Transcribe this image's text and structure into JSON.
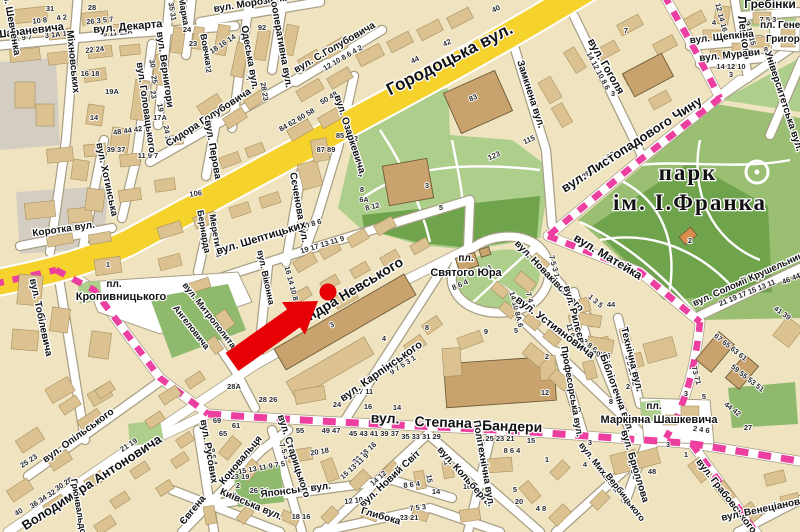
{
  "map": {
    "colors": {
      "block_bg": "#EFE3C0",
      "building": "#DCC291",
      "building_outline": "#A8905F",
      "public_building": "#C9A36E",
      "public_outline": "#6E5B36",
      "orange_building": "#D98D4E",
      "road_fill": "#FFFFFF",
      "road_casing": "#A89F85",
      "major_road_yellow": "#F5D22C",
      "green_light": "#AECE8C",
      "green_mid": "#8FB96D",
      "green_dark": "#6FA44C",
      "gray_zone": "#D4CEC2",
      "route_pink": "#EC3F9F",
      "marker_red": "#E80007",
      "label_color": "#121212"
    },
    "street_labels": [
      [
        "Шараневича",
        30,
        34,
        -7,
        11
      ],
      [
        "вул. Декарта",
        128,
        30,
        -5,
        11
      ],
      [
        "Міхновських",
        70,
        62,
        84,
        10
      ],
      [
        "вул. Головацького",
        143,
        108,
        82,
        10
      ],
      [
        "вул. Вернигори",
        162,
        70,
        82,
        10
      ],
      [
        "Марка",
        181,
        12,
        80,
        9
      ],
      [
        "Вовчка",
        203,
        50,
        80,
        9
      ],
      [
        "Одеська вул.",
        247,
        58,
        80,
        10
      ],
      [
        "вул. Морозенка",
        252,
        6,
        -9,
        10
      ],
      [
        "Кооперативна вул.",
        278,
        42,
        80,
        10
      ],
      [
        "вул. С.Голубовича",
        336,
        50,
        -30,
        10
      ],
      [
        "Сидора Голубовича",
        210,
        120,
        -33,
        10
      ],
      [
        "вул. Перова",
        210,
        150,
        80,
        10
      ],
      [
        "Бернарда",
        201,
        232,
        80,
        9
      ],
      [
        "Меретина",
        213,
        236,
        80,
        9
      ],
      [
        "Коротка вул.",
        64,
        232,
        -8,
        10
      ],
      [
        "вул. Хотинська",
        104,
        180,
        78,
        10
      ],
      [
        "Сєченова вул.",
        296,
        208,
        80,
        10
      ],
      [
        "вул. Озаркевича",
        347,
        135,
        72,
        10
      ],
      [
        "Городоцька вул.",
        452,
        64,
        -27,
        17
      ],
      [
        "Замкнена вул.",
        528,
        95,
        72,
        10
      ],
      [
        "вул. Гоголя",
        603,
        68,
        60,
        11
      ],
      [
        "Лепкого",
        741,
        38,
        82,
        11
      ],
      [
        "Гребінки",
        770,
        8,
        0,
        12
      ],
      [
        "вул. Щепкіна",
        722,
        40,
        -6,
        10
      ],
      [
        "вул. Мурави",
        730,
        58,
        -6,
        10
      ],
      [
        "пл. Генерала",
        792,
        28,
        0,
        10
      ],
      [
        "Григоренка",
        794,
        42,
        0,
        10
      ],
      [
        "Університетська вул.",
        781,
        102,
        72,
        10
      ],
      [
        "вул. Листопадового Чину",
        634,
        148,
        -33,
        13
      ],
      [
        "парк",
        688,
        180,
        0,
        23,
        1
      ],
      [
        "ім. І.Франка",
        690,
        210,
        0,
        23,
        1
      ],
      [
        "вул. Матейка",
        606,
        260,
        31,
        12
      ],
      [
        "вул. Соломії Крушельницької",
        758,
        278,
        -24,
        9.5
      ],
      [
        "пл.",
        466,
        261,
        0,
        10
      ],
      [
        "Святого Юра",
        466,
        276,
        0,
        11
      ],
      [
        "вул. Шептицьких",
        262,
        241,
        -17,
        11
      ],
      [
        "вул. Віконна",
        263,
        278,
        78,
        9
      ],
      [
        "вул. Олександра Невського",
        322,
        314,
        -31,
        14
      ],
      [
        "вул. Карпінського",
        383,
        374,
        -35,
        11
      ],
      [
        "вул. Новаківського",
        547,
        278,
        46,
        10
      ],
      [
        "вул. Рилєєва",
        572,
        318,
        75,
        10
      ],
      [
        "вул. Устияновича",
        553,
        330,
        37,
        11
      ],
      [
        "Технічна вул.",
        629,
        360,
        76,
        10
      ],
      [
        "Бібліотечна вул.",
        614,
        394,
        70,
        10
      ],
      [
        "Професорська вул.",
        569,
        392,
        80,
        9.5
      ],
      [
        "вул.",
        385,
        423,
        2,
        14
      ],
      [
        "Степана",
        443,
        427,
        2,
        14
      ],
      [
        "Бандери",
        512,
        431,
        2,
        14
      ],
      [
        "вул. Кольберга",
        462,
        478,
        48,
        10
      ],
      [
        "Політехнічна вул.",
        481,
        464,
        80,
        10
      ],
      [
        "вул. Новий Світ",
        392,
        481,
        -43,
        10
      ],
      [
        "Глибока",
        380,
        519,
        16,
        10
      ],
      [
        "Японська вул.",
        296,
        493,
        -7,
        10
      ],
      [
        "вул. Старицького",
        291,
        457,
        72,
        10
      ],
      [
        "Коновальця",
        243,
        462,
        -50,
        10
      ],
      [
        "Євгена",
        195,
        512,
        -50,
        10
      ],
      [
        "Київська вул.",
        250,
        507,
        23,
        10
      ],
      [
        "вул. Русових",
        206,
        452,
        80,
        10
      ],
      [
        "вул. Опільського",
        80,
        438,
        -36,
        10
      ],
      [
        "Володимира Антоновича",
        94,
        486,
        -33,
        13
      ],
      [
        "вул. Тобілевича",
        38,
        318,
        78,
        10
      ],
      [
        "пл.",
        114,
        287,
        0,
        10
      ],
      [
        "Кропивницького",
        121,
        300,
        0,
        11
      ],
      [
        "вул. Митрополита",
        207,
        317,
        52,
        9
      ],
      [
        "Ангеловича",
        189,
        329,
        52,
        9
      ],
      [
        "вул. Шевченка",
        8,
        20,
        80,
        10
      ],
      [
        "Грюнвальдська",
        77,
        514,
        80,
        9
      ],
      [
        "вул. Брюллова",
        632,
        467,
        73,
        10
      ],
      [
        "вул. Михайла",
        597,
        469,
        52,
        9
      ],
      [
        "Вербицького",
        623,
        499,
        52,
        9
      ],
      [
        "пл.",
        654,
        409,
        0,
        10
      ],
      [
        "Маркіяна Шашкевича",
        659,
        423,
        0,
        11
      ],
      [
        "вул. Грабовського",
        724,
        498,
        52,
        10
      ],
      [
        "вул. Венеціанова",
        764,
        512,
        -12,
        10
      ]
    ],
    "house_numbers": [
      [
        "10 8",
        40,
        23,
        -6
      ],
      [
        "4 2",
        62,
        20,
        -6
      ],
      [
        "31",
        50,
        11,
        0
      ],
      [
        "1 9 7",
        24,
        40,
        -6
      ],
      [
        "3 1А 1",
        56,
        37,
        -6
      ],
      [
        "28",
        92,
        10,
        0
      ],
      [
        "26 3 5 7",
        100,
        23,
        -6
      ],
      [
        "9 11 11А",
        118,
        35,
        -6
      ],
      [
        "35 31",
        170,
        12,
        80
      ],
      [
        "24",
        187,
        32,
        0
      ],
      [
        "23",
        193,
        46,
        0
      ],
      [
        "22 24",
        95,
        52,
        -6
      ],
      [
        "16 18",
        90,
        76,
        0
      ],
      [
        "19А",
        112,
        94,
        0
      ],
      [
        "14",
        94,
        120,
        0
      ],
      [
        "48 44 42",
        128,
        133,
        -8
      ],
      [
        "39 37",
        116,
        152,
        0
      ],
      [
        "11 9 7",
        148,
        158,
        0
      ],
      [
        "30",
        150,
        64,
        80
      ],
      [
        "25",
        152,
        80,
        80
      ],
      [
        "23",
        151,
        95,
        80
      ],
      [
        "19",
        158,
        108,
        80
      ],
      [
        "17А",
        160,
        120,
        0
      ],
      [
        "24 18",
        165,
        135,
        80
      ],
      [
        "18 16 14",
        224,
        46,
        -33
      ],
      [
        "24 22",
        205,
        64,
        80
      ],
      [
        "15",
        250,
        80,
        0
      ],
      [
        "28 23",
        262,
        92,
        80
      ],
      [
        "92",
        262,
        30,
        0
      ],
      [
        "84 62 60 58",
        298,
        122,
        -30
      ],
      [
        "50 48",
        330,
        100,
        -30
      ],
      [
        "12 10 8 6 4 2",
        344,
        60,
        -30
      ],
      [
        "44",
        416,
        62,
        -26
      ],
      [
        "42",
        448,
        45,
        -26
      ],
      [
        "40",
        497,
        11,
        -26
      ],
      [
        "83",
        474,
        100,
        -24
      ],
      [
        "85",
        340,
        138,
        0
      ],
      [
        "87 89",
        326,
        152,
        0
      ],
      [
        "2",
        356,
        141,
        0
      ],
      [
        "4",
        360,
        177,
        0
      ],
      [
        "8",
        362,
        192,
        0
      ],
      [
        "6А",
        364,
        202,
        0
      ],
      [
        "8 12",
        373,
        209,
        -15
      ],
      [
        "3",
        427,
        188,
        0
      ],
      [
        "5",
        441,
        210,
        0
      ],
      [
        "16 14 12 10 8 6",
        297,
        231,
        -17
      ],
      [
        "19 17 13 11 9",
        323,
        247,
        -17
      ],
      [
        "16 14 10 8",
        289,
        284,
        75
      ],
      [
        "8 6 4",
        461,
        287,
        -24
      ],
      [
        "3 1",
        488,
        271,
        -24
      ],
      [
        "7 5 3 1",
        552,
        267,
        75
      ],
      [
        "1",
        650,
        133,
        0
      ],
      [
        "28 26 22 20",
        600,
        167,
        -38
      ],
      [
        "14 12 10 8 6",
        596,
        72,
        62
      ],
      [
        "7",
        626,
        33,
        0
      ],
      [
        "3",
        613,
        96,
        0
      ],
      [
        "4",
        714,
        25,
        0
      ],
      [
        "12 14 16",
        719,
        18,
        75
      ],
      [
        "9 11 15",
        748,
        34,
        75
      ],
      [
        "7 5 3",
        768,
        22,
        0
      ],
      [
        "14 12 10",
        731,
        69,
        0
      ],
      [
        "8",
        766,
        52,
        0
      ],
      [
        "3",
        731,
        77,
        0
      ],
      [
        "2",
        690,
        243,
        0
      ],
      [
        "21 19 17 15 13 11",
        748,
        295,
        -22
      ],
      [
        "46 44",
        792,
        281,
        -22
      ],
      [
        "41 39",
        781,
        315,
        35
      ],
      [
        "7 4 2",
        528,
        301,
        75
      ],
      [
        "14 10 8А 6",
        514,
        310,
        75
      ],
      [
        "1 3 5",
        594,
        303,
        40
      ],
      [
        "44",
        611,
        307,
        0
      ],
      [
        "11 9 7",
        569,
        334,
        75
      ],
      [
        "12 8 6 4",
        589,
        348,
        40
      ],
      [
        "6 8 10 12",
        629,
        371,
        75
      ],
      [
        "2",
        628,
        389,
        0
      ],
      [
        "10",
        577,
        412,
        0
      ],
      [
        "8",
        611,
        404,
        0
      ],
      [
        "70 66",
        601,
        357,
        8
      ],
      [
        "73 71",
        694,
        376,
        75
      ],
      [
        "67 65 63 61",
        729,
        349,
        38
      ],
      [
        "59 55 53 51",
        746,
        380,
        38
      ],
      [
        "5",
        704,
        399,
        0
      ],
      [
        "3",
        686,
        396,
        0
      ],
      [
        "2 4 6",
        701,
        432,
        8
      ],
      [
        "44 42",
        731,
        411,
        38
      ],
      [
        "27",
        748,
        430,
        0
      ],
      [
        "3",
        668,
        447,
        0
      ],
      [
        "1",
        686,
        457,
        0
      ],
      [
        "7 5 3",
        631,
        472,
        73
      ],
      [
        "48",
        652,
        474,
        0
      ],
      [
        "3",
        590,
        445,
        0
      ],
      [
        "4",
        585,
        467,
        0
      ],
      [
        "9",
        486,
        334,
        0
      ],
      [
        "5",
        516,
        333,
        0
      ],
      [
        "2",
        547,
        359,
        0
      ],
      [
        "12",
        545,
        395,
        0
      ],
      [
        "3",
        333,
        327,
        -30
      ],
      [
        "4",
        384,
        341,
        0
      ],
      [
        "8",
        427,
        330,
        0
      ],
      [
        "24",
        337,
        407,
        0
      ],
      [
        "16",
        368,
        409,
        0
      ],
      [
        "14",
        397,
        410,
        0
      ],
      [
        "28А",
        234,
        389,
        0
      ],
      [
        "28 26",
        268,
        402,
        0
      ],
      [
        "17 11",
        364,
        394,
        0
      ],
      [
        "9 7 5 3 1",
        404,
        367,
        -33
      ],
      [
        "69",
        217,
        423,
        0
      ],
      [
        "65",
        223,
        436,
        0
      ],
      [
        "61",
        236,
        428,
        0
      ],
      [
        "55",
        300,
        433,
        0
      ],
      [
        "49 47",
        331,
        433,
        0
      ],
      [
        "45 43 41 39 37",
        374,
        436,
        0
      ],
      [
        "35 33 31 29",
        421,
        439,
        0
      ],
      [
        "25 23 21",
        500,
        441,
        0
      ],
      [
        "15",
        531,
        443,
        0
      ],
      [
        "22 18 16",
        366,
        455,
        -42
      ],
      [
        "15 13 11 9",
        356,
        468,
        -42
      ],
      [
        "14 12",
        380,
        480,
        -42
      ],
      [
        "8 6 4",
        512,
        453,
        0
      ],
      [
        "16",
        467,
        489,
        0
      ],
      [
        "5",
        515,
        492,
        0
      ],
      [
        "20",
        519,
        504,
        0
      ],
      [
        "4 8",
        541,
        511,
        0
      ],
      [
        "1",
        547,
        462,
        0
      ],
      [
        "11",
        444,
        462,
        80
      ],
      [
        "15",
        427,
        479,
        80
      ],
      [
        "8 6 4",
        211,
        457,
        80
      ],
      [
        "2",
        238,
        488,
        0
      ],
      [
        "26 24",
        259,
        493,
        0
      ],
      [
        "18 16",
        301,
        519,
        0
      ],
      [
        "12 10",
        354,
        503,
        -7
      ],
      [
        "8 6 4",
        412,
        487,
        -7
      ],
      [
        "14",
        436,
        494,
        0
      ],
      [
        "7 5 3",
        418,
        510,
        -7
      ],
      [
        "23 21",
        409,
        520,
        0
      ],
      [
        "7 5 3",
        282,
        452,
        70
      ],
      [
        "15 13 11 9 7 5",
        262,
        470,
        -10
      ],
      [
        "23 19",
        240,
        479,
        0
      ],
      [
        "21 19",
        130,
        447,
        -33
      ],
      [
        "25 23",
        30,
        463,
        -33
      ],
      [
        "30 28",
        65,
        486,
        -33
      ],
      [
        "36 34 32",
        44,
        501,
        -33
      ],
      [
        "40",
        20,
        514,
        -33
      ],
      [
        "20 18",
        320,
        454,
        -10
      ],
      [
        "1",
        108,
        267,
        0
      ],
      [
        "123",
        495,
        158,
        -24
      ],
      [
        "115",
        530,
        142,
        -24
      ],
      [
        "106",
        196,
        196,
        -8
      ]
    ],
    "marker": {
      "color": "#E80007",
      "dot": {
        "x": 328,
        "y": 292,
        "r": 8.5
      },
      "arrow_points": "318,301 305,334.8 299.9,327.4 238.4,371 225.6,353 287.1,309.4 281.9,302.1"
    }
  }
}
